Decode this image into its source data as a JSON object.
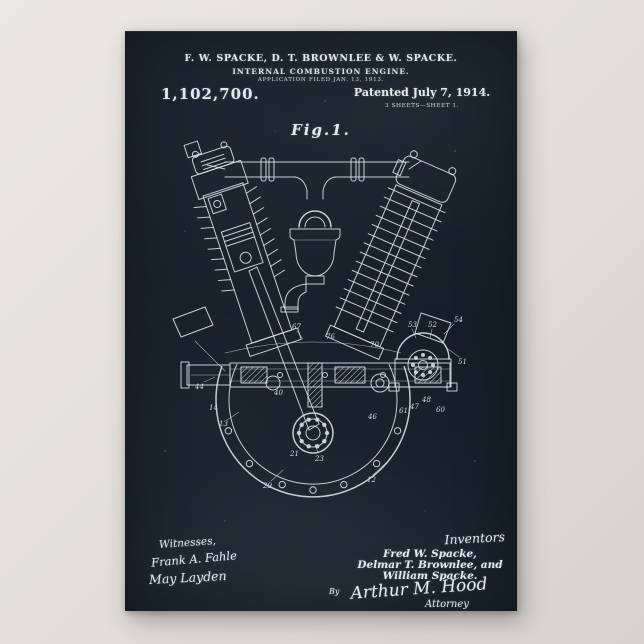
{
  "poster": {
    "colors": {
      "board": "#141d27",
      "chalk": "#e2e9ee",
      "matte": "#e4e1de"
    },
    "header": {
      "inventors_line": "F. W. SPACKE, D. T. BROWNLEE & W. SPACKE.",
      "title_line": "INTERNAL COMBUSTION ENGINE.",
      "application_line": "APPLICATION FILED JAN. 13, 1913.",
      "patent_number": "1,102,700.",
      "patented_line": "Patented July 7, 1914.",
      "sheets_line": "3 SHEETS—SHEET 1."
    },
    "figure_label": "Fig.1.",
    "drawing": {
      "reference_numbers": [
        "12",
        "13",
        "14",
        "21",
        "23",
        "29",
        "40",
        "44",
        "46",
        "47",
        "48",
        "51",
        "52",
        "53",
        "54",
        "60",
        "61",
        "67",
        "70",
        "76"
      ]
    },
    "footer": {
      "witnesses_label": "Witnesses,",
      "witness_signatures": [
        "Frank A. Fahle",
        "May Layden"
      ],
      "inventors_label": "Inventors",
      "inventor_names": [
        "Fred W. Spacke,",
        "Delmar T. Brownlee, and",
        "William Spacke."
      ],
      "by_label": "By",
      "attorney_signature": "Arthur M. Hood",
      "attorney_label": "Attorney"
    }
  }
}
